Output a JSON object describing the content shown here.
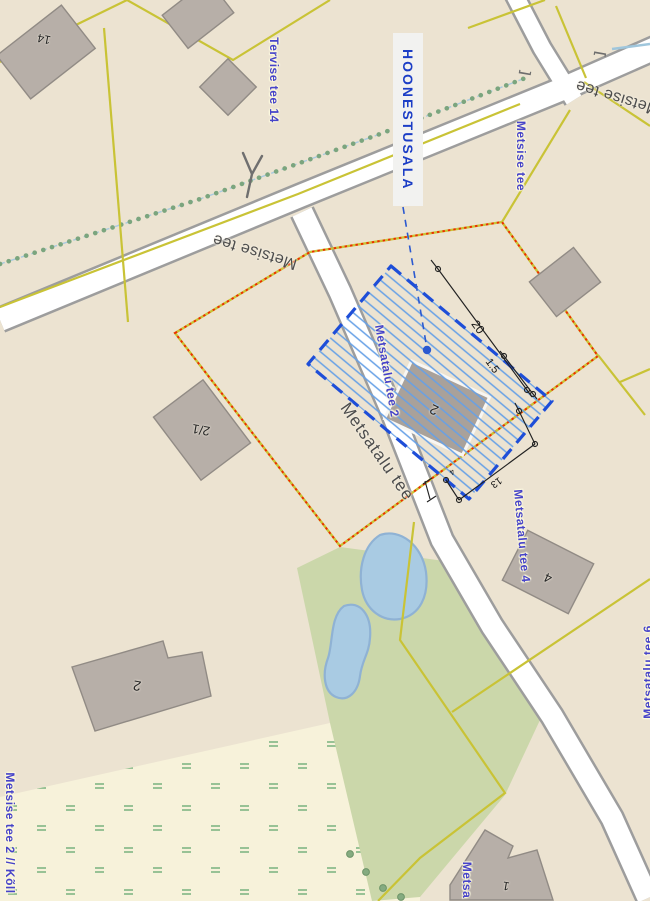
{
  "app": {
    "type": "planning-map-view"
  },
  "colors": {
    "background": "#ece3d1",
    "building_area_blue": "#1e4ed8",
    "hatch_blue": "#66a0e6",
    "planning_boundary_red": "#ee2b00",
    "cadastral_yellow": "#c9c336",
    "address_label_blue": "#4643c9",
    "green_area": "#cbd7aa",
    "meadow_area": "#f7f2da",
    "pond_blue": "#a9cbe3",
    "building_gray": "#b7afa8",
    "road_fill": "#ffffff",
    "road_casing": "#9d9d9d"
  },
  "overlay": {
    "building_area_label": "HOONESTUSALA",
    "dim_20": "20",
    "dim_1_5": "1.5",
    "dim_13": "13",
    "dim_4": "4"
  },
  "address_labels": {
    "tervise_tee_14": "Tervise tee 14",
    "metsise_tee": "Metsise tee",
    "metsatalu_tee_2": "Metsatalu tee 2",
    "metsatalu_tee_4": "Metsatalu tee 4",
    "metsatalu_tee_6": "Metsatalu tee 6",
    "metsise_tee_2_koll": "Metsise tee 2 // Kõll",
    "metsa_partial": "Metsa"
  },
  "road_labels": {
    "metsise_tee_west": "Metsise tee",
    "metsise_tee_east": "Metsise tee",
    "metsatalu_tee": "Metsatalu tee"
  },
  "building_labels": {
    "house_14": "14",
    "house_2_1": "2/1",
    "house_2_plan": "2",
    "house_4": "4",
    "house_2_south": "2",
    "house_1": "1"
  },
  "symbols": {
    "culvert_open": "[",
    "culvert_close": "]"
  }
}
